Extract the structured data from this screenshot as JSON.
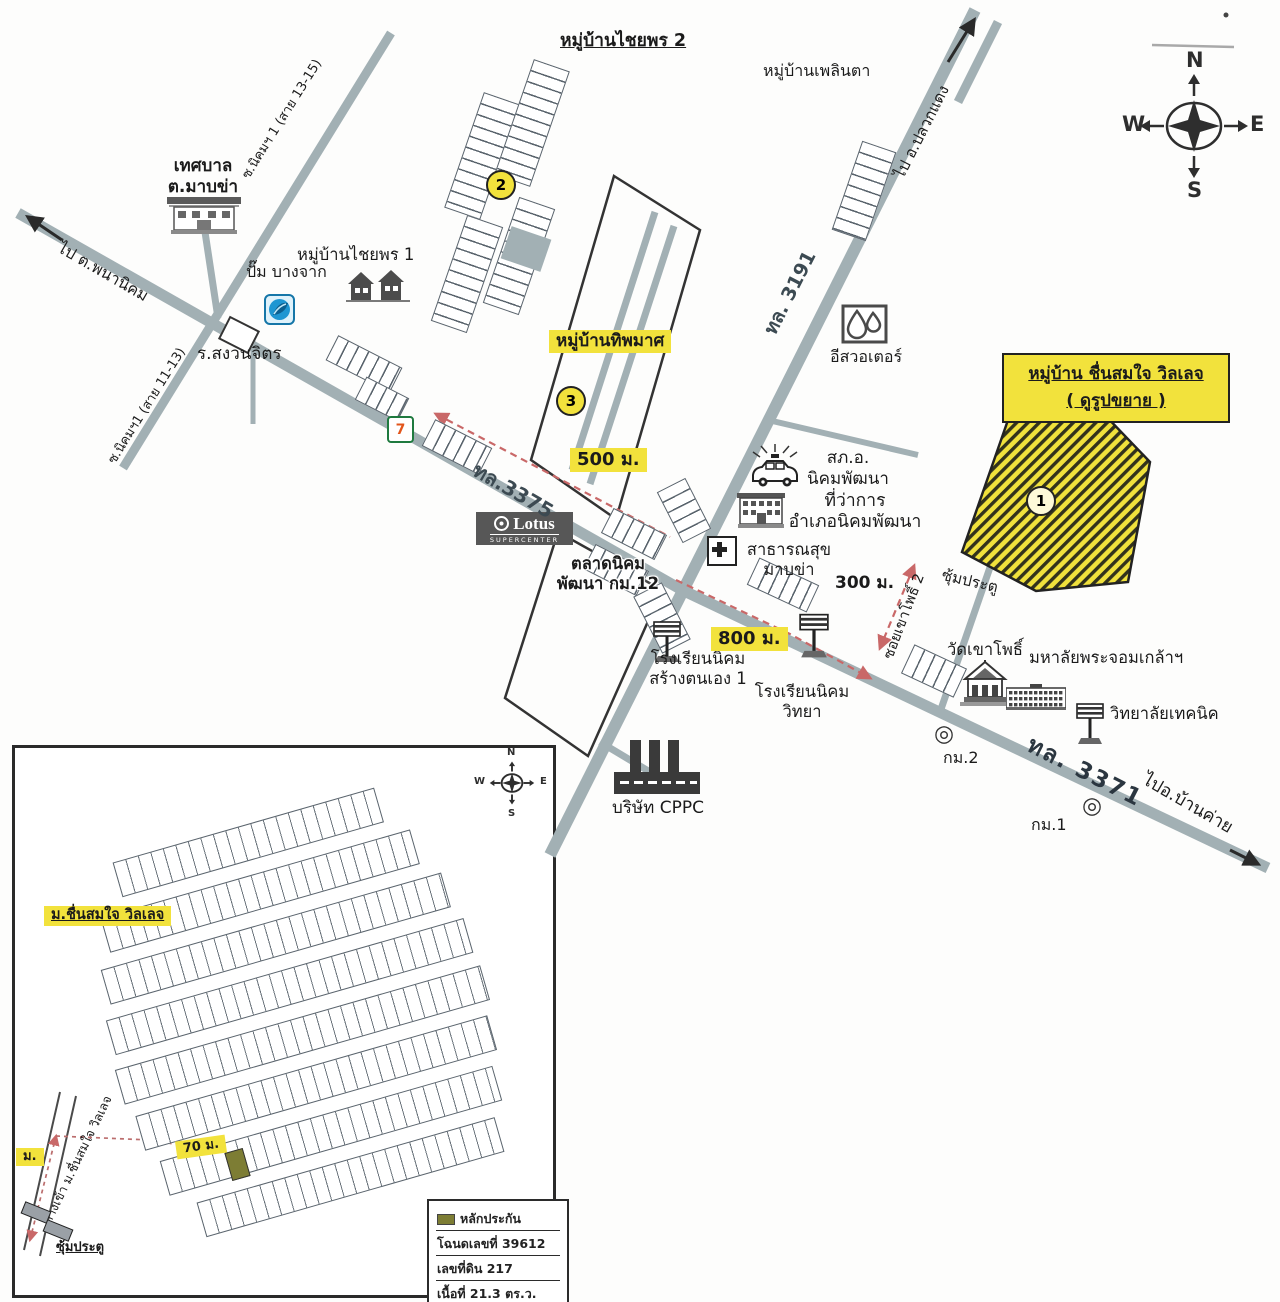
{
  "compass": {
    "n": "N",
    "e": "E",
    "s": "S",
    "w": "W"
  },
  "map": {
    "title_chaiyaporn2": "หมู่บ้านไชยพร 2",
    "ploenta": "หมู่บ้านเพลินตา",
    "to_pluakdaeng": "ไป อ.ปลวกแดง",
    "tessaban_line1": "เทศบาล",
    "tessaban_line2": "ต.มาบข่า",
    "to_phananikhom": "ไป ต.พนานิคม",
    "soi_nikhom_13_15": "ซ.นิคมฯ 1 (สาย 13-15)",
    "soi_nikhom_11_13": "ซ.นิคมฯ1 (สาย 11-13)",
    "chaiyaporn1": "หมู่บ้านไชยพร 1",
    "bangchak": "ปั๊ม บางจาก",
    "sanguanchit": "ร.สงวนจิตร",
    "seven": "7",
    "num1": "1",
    "num2": "2",
    "num3": "3",
    "thipphamat": "หมู่บ้านทิพมาศ",
    "d500": "500 ม.",
    "d800": "800 ม.",
    "d300": "300 ม.",
    "hw3191": "ทล. 3191",
    "hw3375": "ทล.3375",
    "hw3371": "ทล. 3371",
    "to_bankhai": "ไปอ.บ้านค่าย",
    "eastwater": "อีสวอเตอร์",
    "box_line1": "หมู่บ้าน ชื่นสมใจ วิลเลจ",
    "box_line2": "( ดูรูปขยาย )",
    "lotus": "Lotus",
    "lotus_sub": "SUPERCENTER",
    "market_line1": "ตลาดนิคม",
    "market_line2": "พัฒนา กม.12",
    "police_line1": "สภ.อ.",
    "police_line2": "นิคมพัฒนา",
    "district_line1": "ที่ว่าการ",
    "district_line2": "อำเภอนิคมพัฒนา",
    "health_line1": "สาธารณสุข",
    "health_line2": "มาบข่า",
    "gate": "ซุ้มประตู",
    "soi_khaopho2": "ซอยเขาโพธิ์ 2",
    "wat": "วัดเขาโพธิ์",
    "university": "มหาลัยพระจอมเกล้าฯ",
    "technic": "วิทยาลัยเทคนิค",
    "school1_line1": "โรงเรียนนิคม",
    "school1_line2": "สร้างตนเอง 1",
    "school2_line1": "โรงเรียนนิคม",
    "school2_line2": "วิทยา",
    "cppc": "บริษัท CPPC",
    "km2": "กม.2",
    "km1": "กม.1",
    "km_marker": "◎"
  },
  "inset": {
    "title": "ม.ชื่นสมใจ วิลเลจ",
    "entrance": "ทางเข้า ม.ชื่นสมใจ วิลเลจ",
    "gate": "ซุ้มประตู",
    "d70": "70 ม.",
    "m_edge": "ม.",
    "legend_title": "หลักประกัน",
    "legend_deed": "โฉนดเลขที่ 39612",
    "legend_parcel": "เลขที่ดิน 217",
    "legend_area": "เนื้อที่ 21.3 ตร.ว.",
    "legend_house": "บ้านเลขที่ ไม่ติด"
  },
  "colors": {
    "road": "#a2b0b4",
    "highlight_yellow": "#f2e23c",
    "route_red": "#c96868",
    "olive": "#7d7d34"
  }
}
